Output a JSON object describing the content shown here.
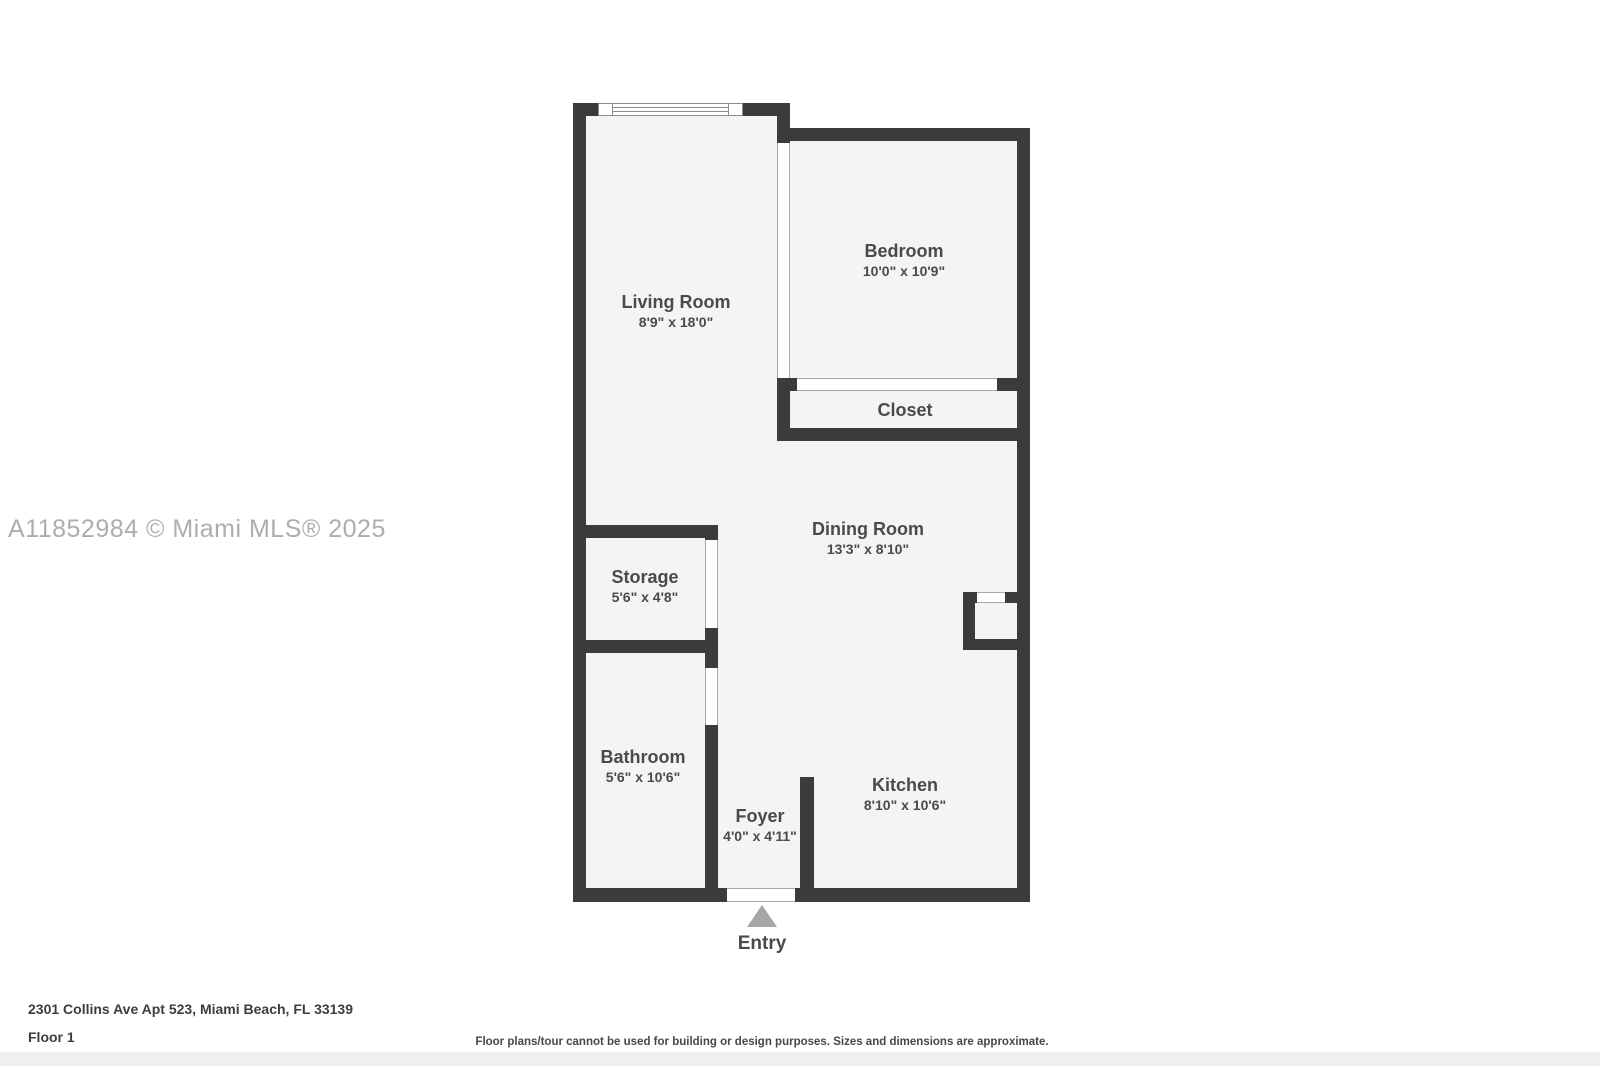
{
  "watermark": "A11852984 © Miami MLS® 2025",
  "rooms": {
    "living_room": {
      "name": "Living Room",
      "dims": "8'9\" x 18'0\""
    },
    "bedroom": {
      "name": "Bedroom",
      "dims": "10'0\" x 10'9\""
    },
    "closet": {
      "name": "Closet"
    },
    "dining_room": {
      "name": "Dining Room",
      "dims": "13'3\" x 8'10\""
    },
    "storage": {
      "name": "Storage",
      "dims": "5'6\" x 4'8\""
    },
    "bathroom": {
      "name": "Bathroom",
      "dims": "5'6\" x 10'6\""
    },
    "foyer": {
      "name": "Foyer",
      "dims": "4'0\" x 4'11\""
    },
    "kitchen": {
      "name": "Kitchen",
      "dims": "8'10\" x 10'6\""
    }
  },
  "entry": {
    "label": "Entry"
  },
  "footer": {
    "address": "2301 Collins Ave Apt 523, Miami Beach, FL 33139",
    "floor": "Floor 1",
    "disclaimer": "Floor plans/tour cannot be used for building or design purposes. Sizes and dimensions are approximate."
  },
  "colors": {
    "wall": "#3b3b3b",
    "floor": "#f4f4f4",
    "label_text": "#4a4a4a",
    "entry_arrow": "#a6a6a6",
    "watermark": "#adadad",
    "footer_strip": "#f0f0f0"
  }
}
